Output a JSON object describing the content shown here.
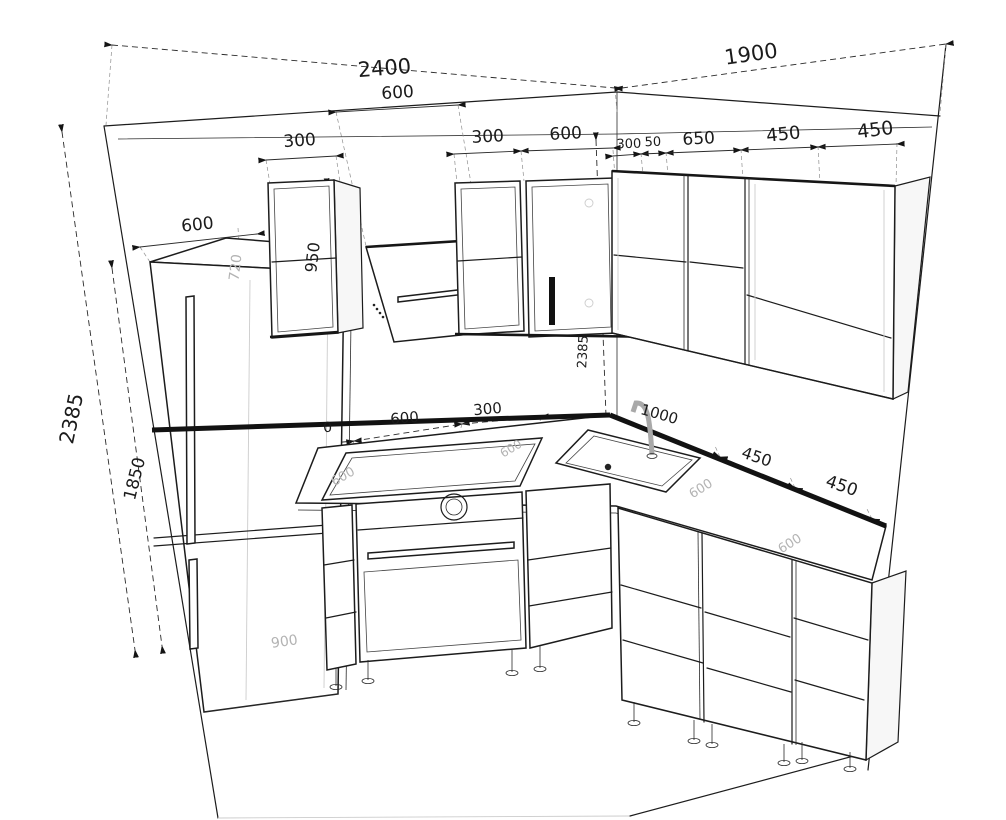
{
  "drawing": {
    "title": "Kitchen corner layout — 3D wireframe with dimensions",
    "units": "mm"
  },
  "dims": {
    "top": {
      "left_wall": "2400",
      "right_wall": "1900"
    },
    "upper": {
      "hood_span": "600",
      "cab_left": "300",
      "cab_mid_left": "300",
      "cab_mid": "600",
      "corner": "300",
      "filler": "50",
      "cab_650": "650",
      "cab_450_a": "450",
      "cab_450_b": "450",
      "cab_height": "950",
      "hood_height": "720"
    },
    "vertical": {
      "wall_left": "2385",
      "fridge_height": "1850",
      "wall_corner": "2385"
    },
    "fridge": {
      "width": "600",
      "inner": "900"
    },
    "counter": {
      "partial": "0",
      "hob_span": "600",
      "beside_hob": "300",
      "sink_run": "1000",
      "cab_450_a": "450",
      "cab_450_b": "450",
      "depth_1": "600",
      "depth_2": "600",
      "depth_3": "600",
      "depth_4": "600"
    }
  }
}
